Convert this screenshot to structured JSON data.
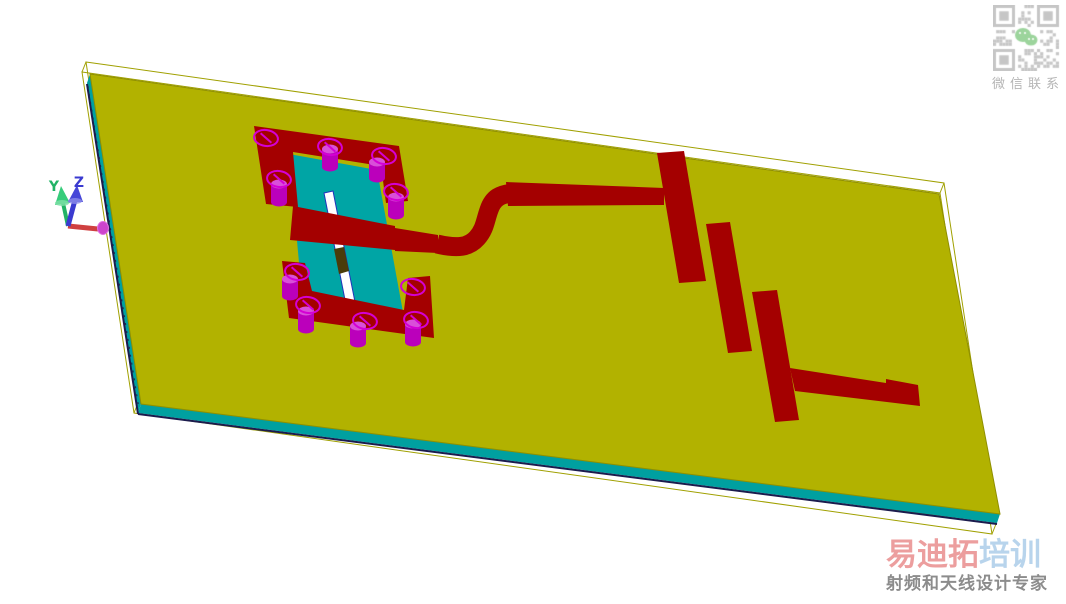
{
  "axis": {
    "y_label": "Y",
    "z_label": "Z"
  },
  "qr": {
    "caption": "微信联系"
  },
  "watermark": {
    "brand_primary": "易迪拓",
    "brand_secondary": "培训",
    "tagline": "射频和天线设计专家"
  },
  "colors": {
    "bg": "#ffffff",
    "board": "#b2b200",
    "board-edge": "#8f8f00",
    "substrate-side": "#00a0a0",
    "copper": "#a40000",
    "chip": "#00a5a5",
    "via": "#bb00bb",
    "via-light": "#d94fd9",
    "via-ring": "#d400d4",
    "wire": "#a0a000",
    "navy": "#1b1b4d",
    "slot-outline": "#2233bb",
    "slot-brown": "#4a3c0a",
    "axis-x": "#cf4040",
    "axis-x-head": "#cc44cc",
    "axis-y": "#22b366",
    "axis-y-cone": "#36cc7a",
    "axis-z": "#3a3ad0",
    "axis-z-cone": "#4646d8",
    "qr": "#c6c6c6",
    "wechat": "#9cd49c",
    "caption": "#b5b5b5",
    "brand-pink": "#ec9e9e",
    "brand-blue": "#b8d4ec",
    "tagline": "#8c8c8c"
  }
}
